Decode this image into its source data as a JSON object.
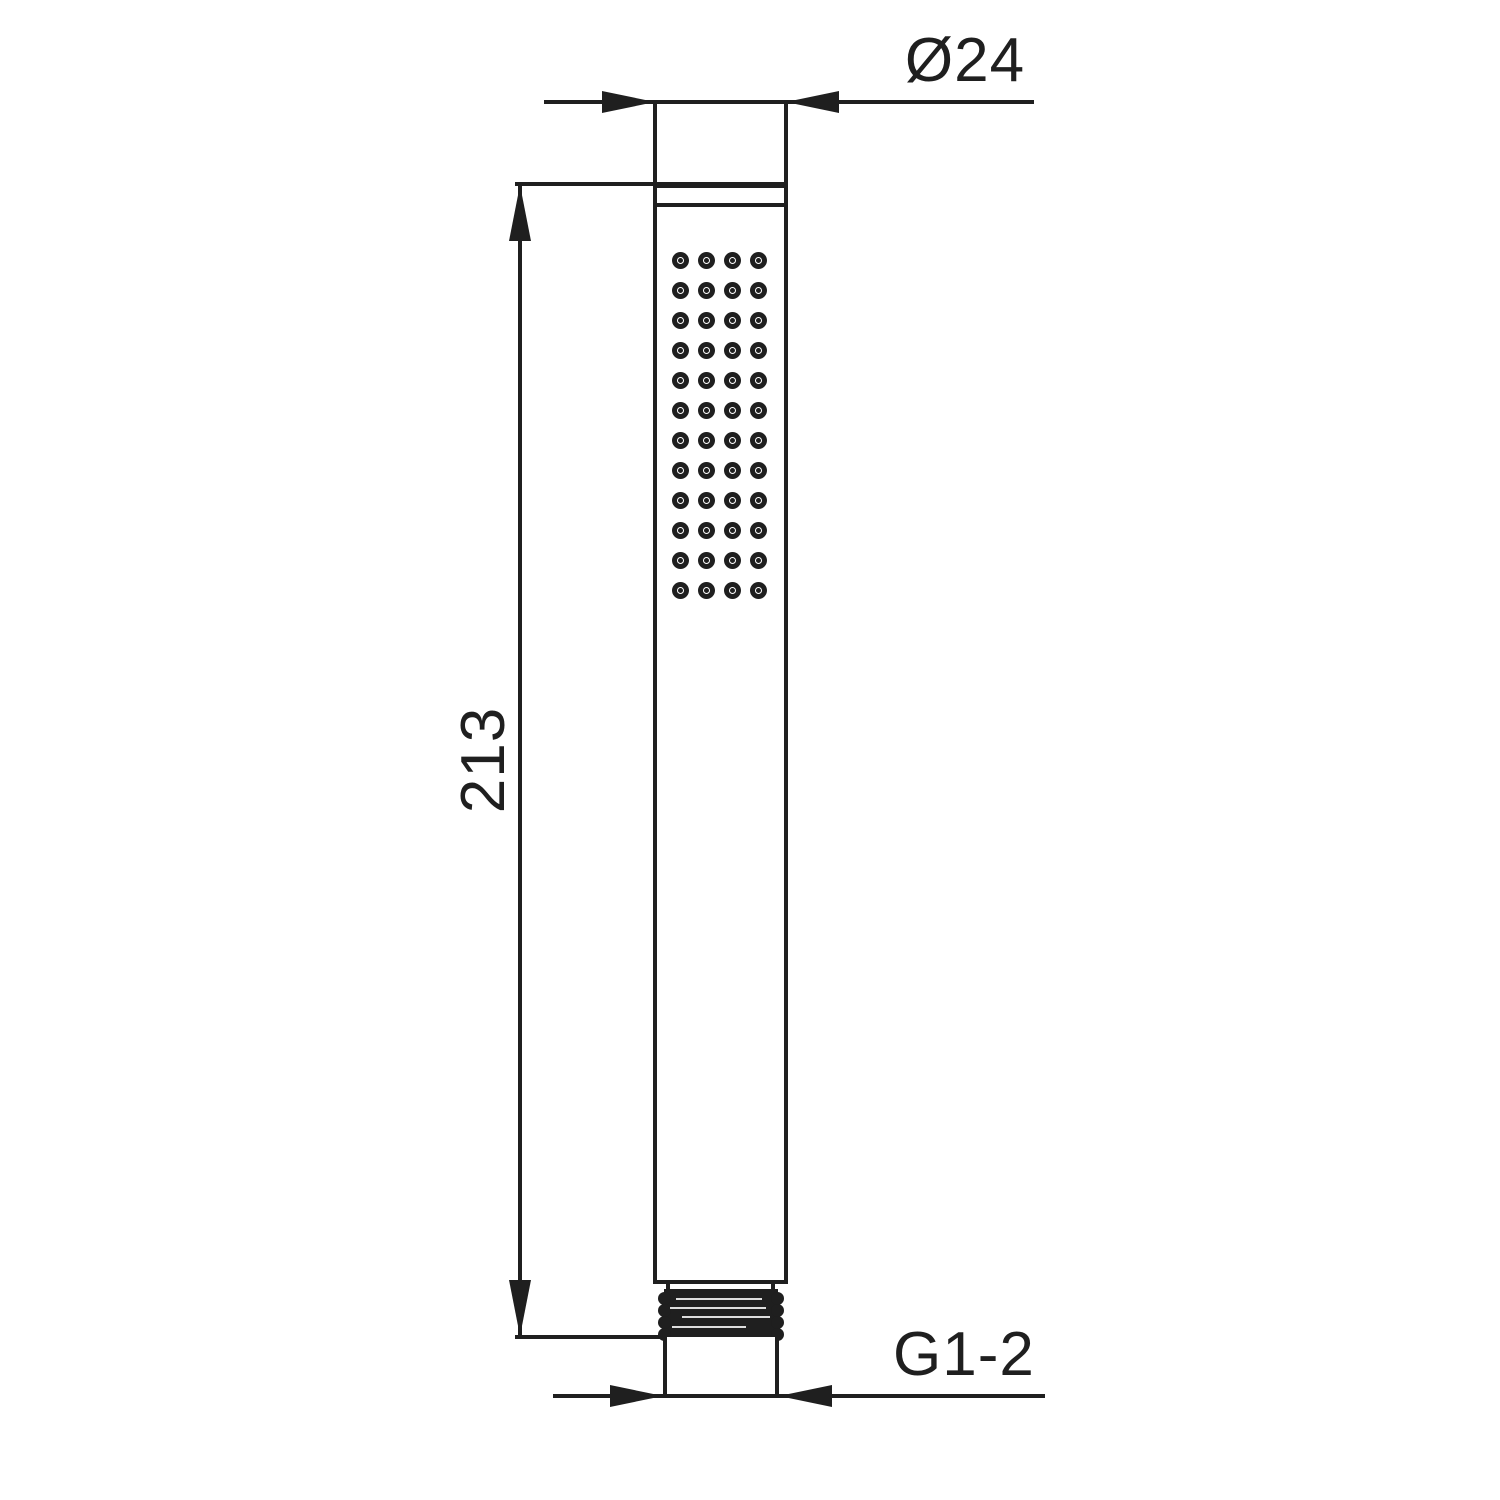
{
  "drawing": {
    "subject": "stick-hand-shower-front-elevation",
    "background_color": "#ffffff",
    "line_color": "#1f1f1f",
    "dimensions": {
      "diameter_label": "Ø24",
      "length_label": "213",
      "thread_label": "G1-2"
    },
    "spray_grid": {
      "rows": 12,
      "columns": 4
    }
  }
}
